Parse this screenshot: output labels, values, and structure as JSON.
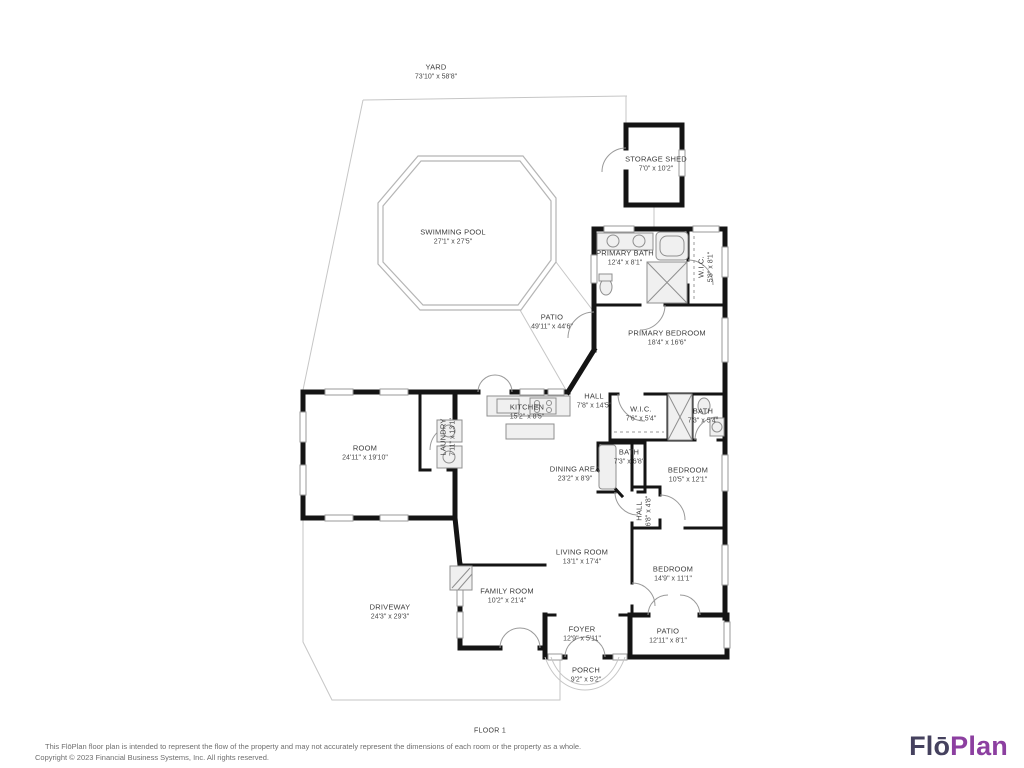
{
  "rooms": [
    {
      "name": "YARD",
      "dims": "73'10\" x 58'8\""
    },
    {
      "name": "SWIMMING POOL",
      "dims": "27'1\" x 27'5\""
    },
    {
      "name": "STORAGE SHED",
      "dims": "7'0\" x 10'2\""
    },
    {
      "name": "PRIMARY BATH",
      "dims": "12'4\" x 8'1\""
    },
    {
      "name": "W.I.C.",
      "dims": "5'8\" x 8'1\""
    },
    {
      "name": "PRIMARY BEDROOM",
      "dims": "18'4\" x 16'6\""
    },
    {
      "name": "PATIO",
      "dims": "49'11\" x 44'6\""
    },
    {
      "name": "HALL",
      "dims": "7'8\" x 14'5\""
    },
    {
      "name": "KITCHEN",
      "dims": "15'2\" x 8'5\""
    },
    {
      "name": "W.I.C.",
      "dims": "7'6\" x 5'4\""
    },
    {
      "name": "BATH",
      "dims": "7'3\" x 5'4\""
    },
    {
      "name": "ROOM",
      "dims": "24'11\" x 19'10\""
    },
    {
      "name": "LAUNDRY",
      "dims": "7'11\" x 13'1\""
    },
    {
      "name": "DINING AREA",
      "dims": "23'2\" x 8'9\""
    },
    {
      "name": "BATH",
      "dims": "7'3\" x 6'8\""
    },
    {
      "name": "BEDROOM",
      "dims": "10'5\" x 12'1\""
    },
    {
      "name": "LIVING ROOM",
      "dims": "13'1\" x 17'4\""
    },
    {
      "name": "HALL",
      "dims": "6'8\" x 4'8\""
    },
    {
      "name": "BEDROOM",
      "dims": "14'9\" x 11'1\""
    },
    {
      "name": "FAMILY ROOM",
      "dims": "10'2\" x 21'4\""
    },
    {
      "name": "DRIVEWAY",
      "dims": "24'3\" x 29'3\""
    },
    {
      "name": "FOYER",
      "dims": "12'9\" x 5'11\""
    },
    {
      "name": "PATIO",
      "dims": "12'11\" x 8'1\""
    },
    {
      "name": "PORCH",
      "dims": "9'2\" x 5'2\""
    }
  ],
  "footer": {
    "floor_label": "FLOOR 1",
    "disclaimer_line1": "This FlōPlan floor plan is intended to represent the flow of the property and may not accurately represent the dimensions of each room or the property as a whole.",
    "disclaimer_line2": "Copyright © 2023 Financial Business Systems, Inc. All rights reserved.",
    "logo": {
      "part1": "Flō",
      "part2": "Plan",
      "part1_color": "#45415e",
      "part2_color": "#8c3fa0"
    }
  }
}
